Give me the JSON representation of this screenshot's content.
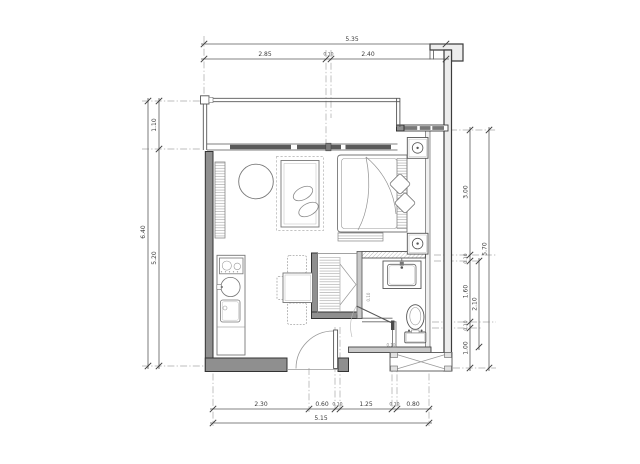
{
  "drawing": {
    "type": "architectural floor plan",
    "colors": {
      "line": "#3f3f3f",
      "wall_fill": "#8f8f8f",
      "glazing_fill": "#5a5a5a",
      "dim_line": "#555555",
      "dim_text": "#3b3b3b",
      "background": "#ffffff",
      "hatch": "#9a9a9a"
    },
    "dims": {
      "top": {
        "overall": "5.35",
        "segments": [
          "2.85",
          "0.10",
          "2.40"
        ]
      },
      "left": {
        "overall": "6.40",
        "segments": [
          "1.10",
          "5.20"
        ]
      },
      "right": {
        "overall": "5.70",
        "mid": "2.10",
        "segments": [
          "3.00",
          "0.10",
          "1.60",
          "0.10",
          "1.00"
        ]
      },
      "bottom": {
        "overall": "5.15",
        "segments": [
          "2.30",
          "0.60",
          "0.10",
          "1.25",
          "0.10",
          "0.80"
        ]
      },
      "small_labels": [
        "0.10",
        "0.10"
      ]
    },
    "elements": [
      "balcony-railing",
      "sliding-glass-door",
      "tv-console",
      "coffee-table",
      "sofa",
      "kitchen-counter",
      "cooktop",
      "kitchen-sink",
      "washing-machine",
      "dining-table",
      "dining-chair",
      "wardrobe",
      "double-bed",
      "pillow",
      "duvet",
      "foot-bench",
      "nightstand",
      "table-lamp",
      "window-band",
      "vanity-basin",
      "toilet",
      "bathroom-sliding-door",
      "entry-door",
      "ac-condenser-ledge"
    ]
  }
}
